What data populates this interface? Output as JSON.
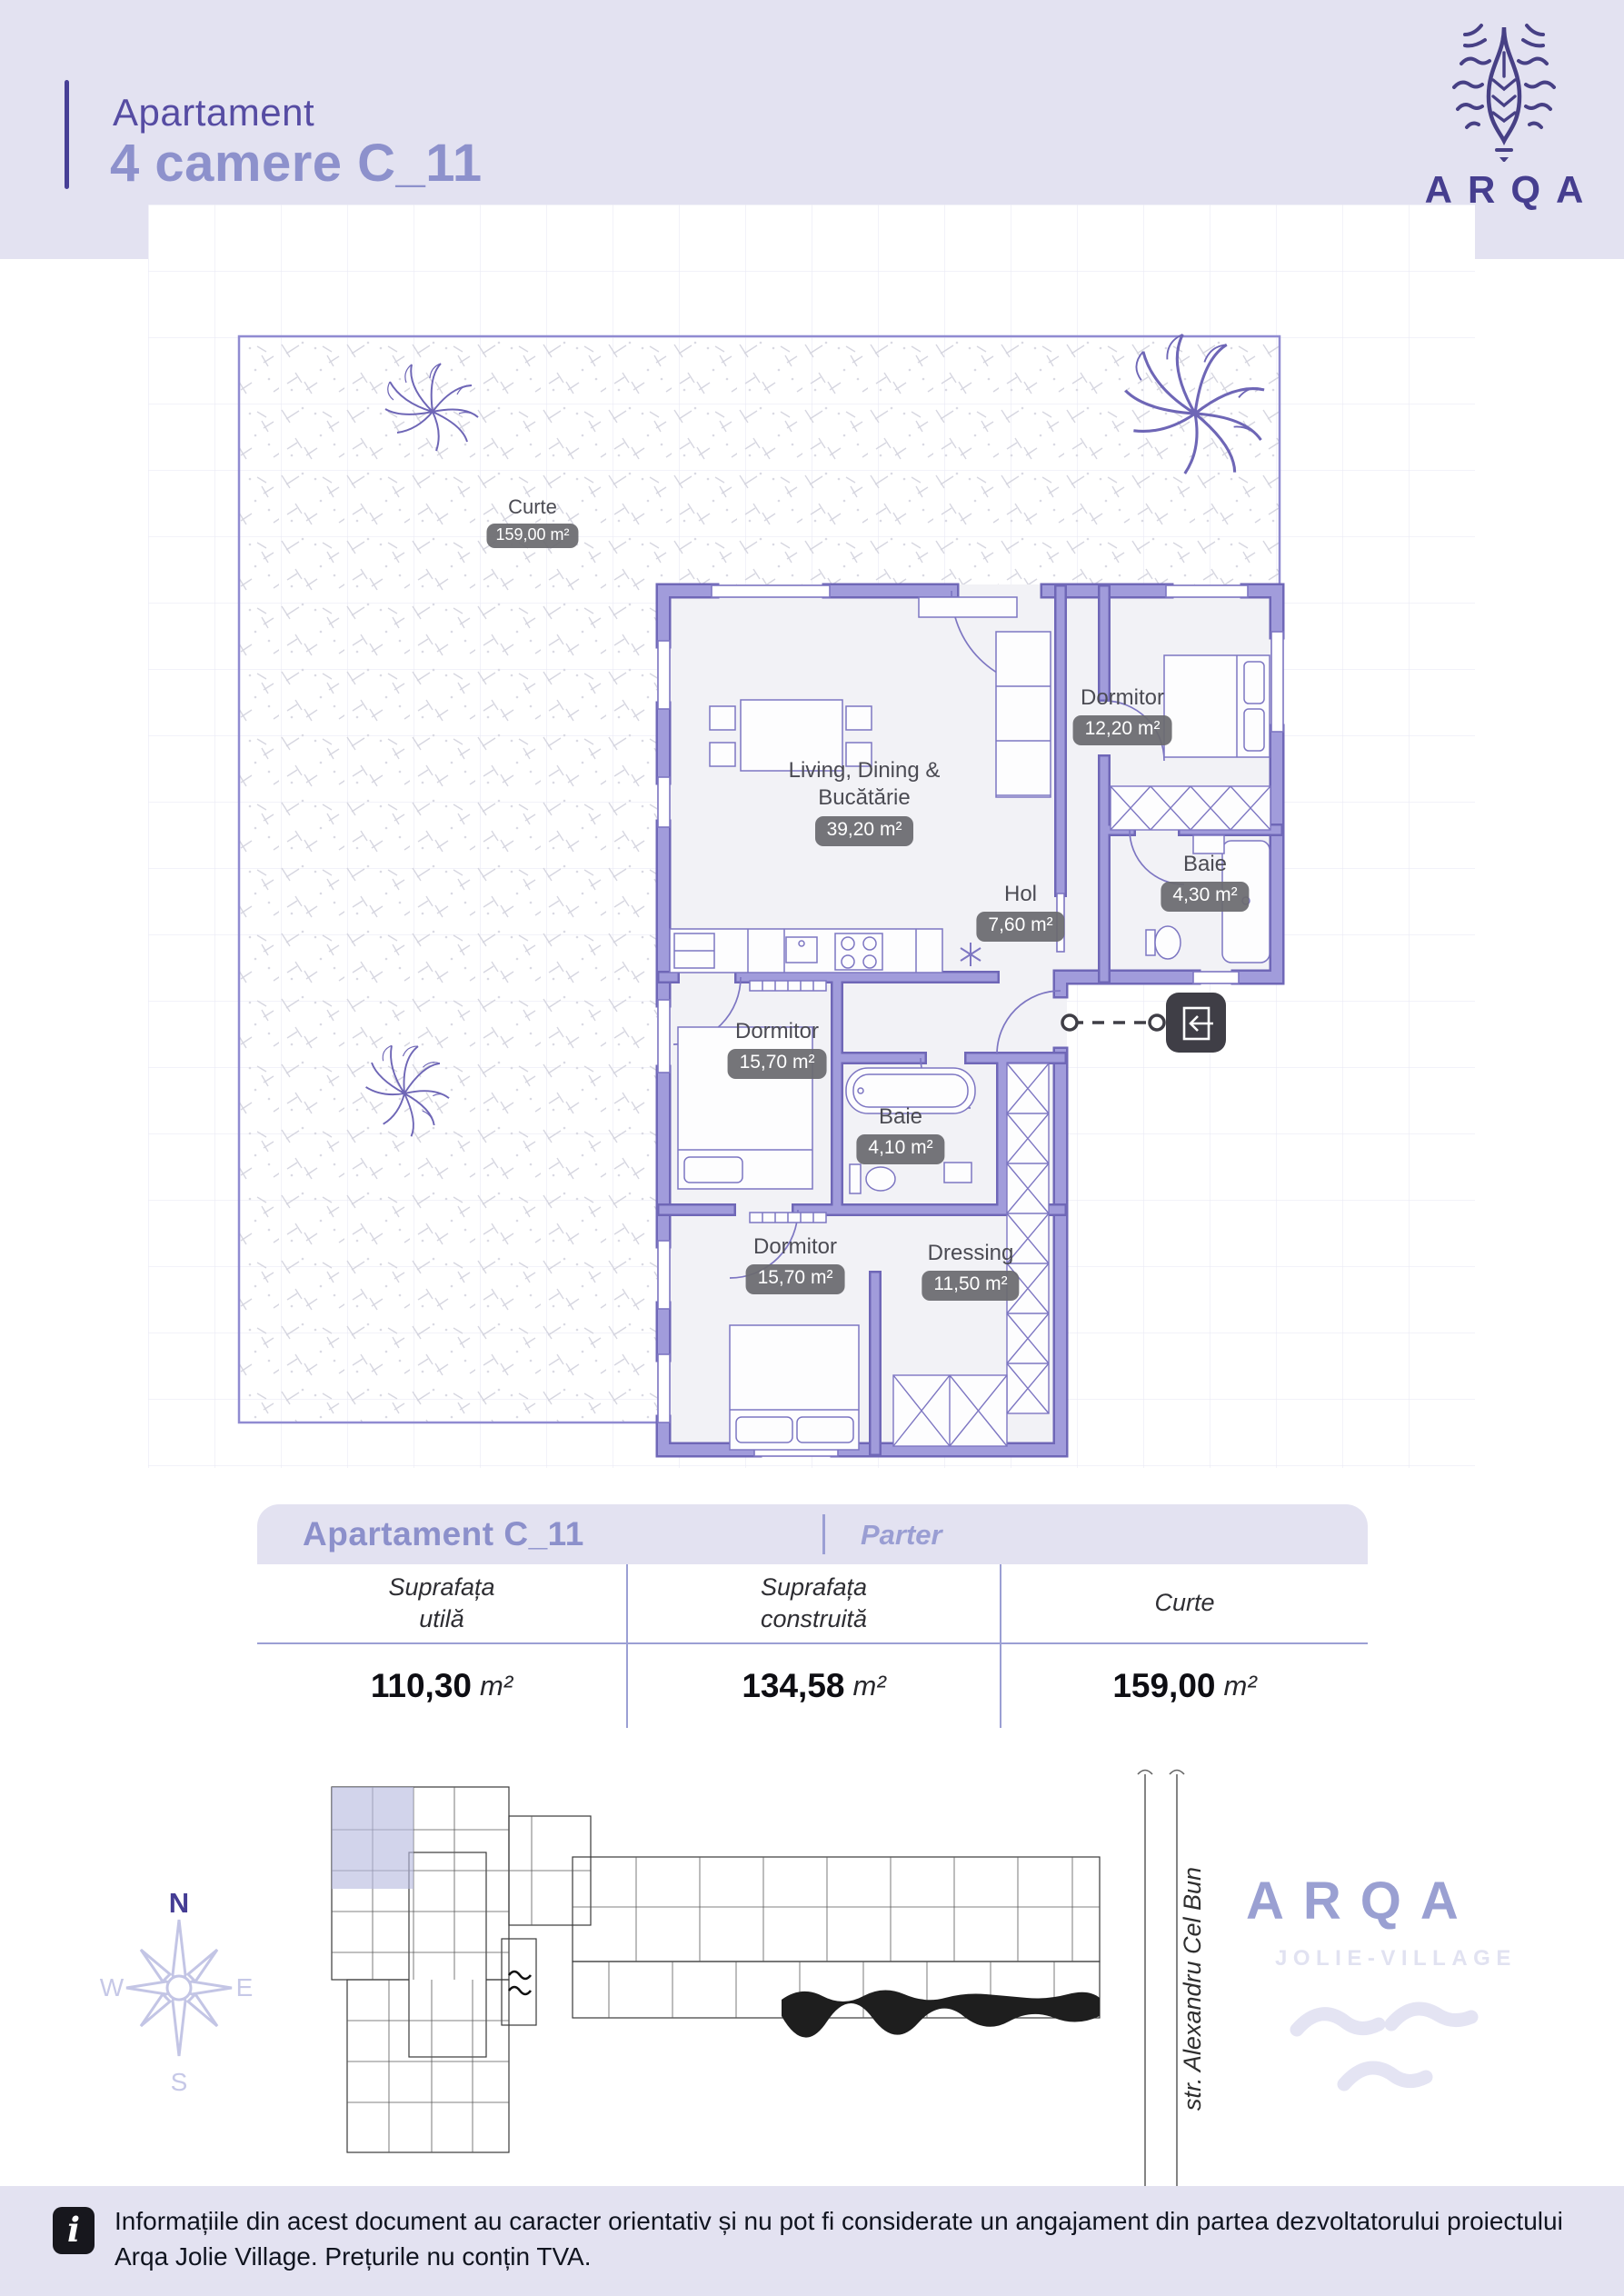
{
  "header": {
    "kicker": "Apartament",
    "title": "4 camere C_11"
  },
  "brand": {
    "name": "ARQA",
    "tagline": "JOLIE-VILLAGE"
  },
  "plan": {
    "curte": {
      "name": "Curte",
      "area": "159,00 m²"
    },
    "living": {
      "name": "Living, Dining & Bucătărie",
      "area": "39,20 m²"
    },
    "dormitor_1": {
      "name": "Dormitor",
      "area": "12,20 m²"
    },
    "baie_1": {
      "name": "Baie",
      "area": "4,30 m²"
    },
    "hol": {
      "name": "Hol",
      "area": "7,60 m²"
    },
    "dormitor_2": {
      "name": "Dormitor",
      "area": "15,70 m²"
    },
    "baie_2": {
      "name": "Baie",
      "area": "4,10 m²"
    },
    "dormitor_3": {
      "name": "Dormitor",
      "area": "15,70 m²"
    },
    "dressing": {
      "name": "Dressing",
      "area": "11,50 m²"
    }
  },
  "summary": {
    "title": "Apartament C_11",
    "floor": "Parter",
    "columns": [
      {
        "label": "Suprafața\nutilă",
        "value": "110,30",
        "unit": "m²"
      },
      {
        "label": "Suprafața\nconstruită",
        "value": "134,58",
        "unit": "m²"
      },
      {
        "label": "Curte",
        "value": "159,00",
        "unit": "m²"
      }
    ]
  },
  "site": {
    "street": "str. Alexandru Cel Bun",
    "compass": {
      "n": "N",
      "e": "E",
      "s": "S",
      "w": "W"
    }
  },
  "footer": {
    "icon_glyph": "i",
    "text": "Informațiile din acest document au caracter orientativ și nu pot fi considerate un angajament din partea dezvoltatorului proiectului\nArqa Jolie Village. Prețurile nu conțin TVA."
  },
  "colors": {
    "band": "#e3e2f1",
    "accent_dark": "#463e8f",
    "accent": "#8d91cc",
    "wall": "#a19cdb",
    "badge": "#6a6a6f",
    "site_highlight": "#b7badf"
  }
}
